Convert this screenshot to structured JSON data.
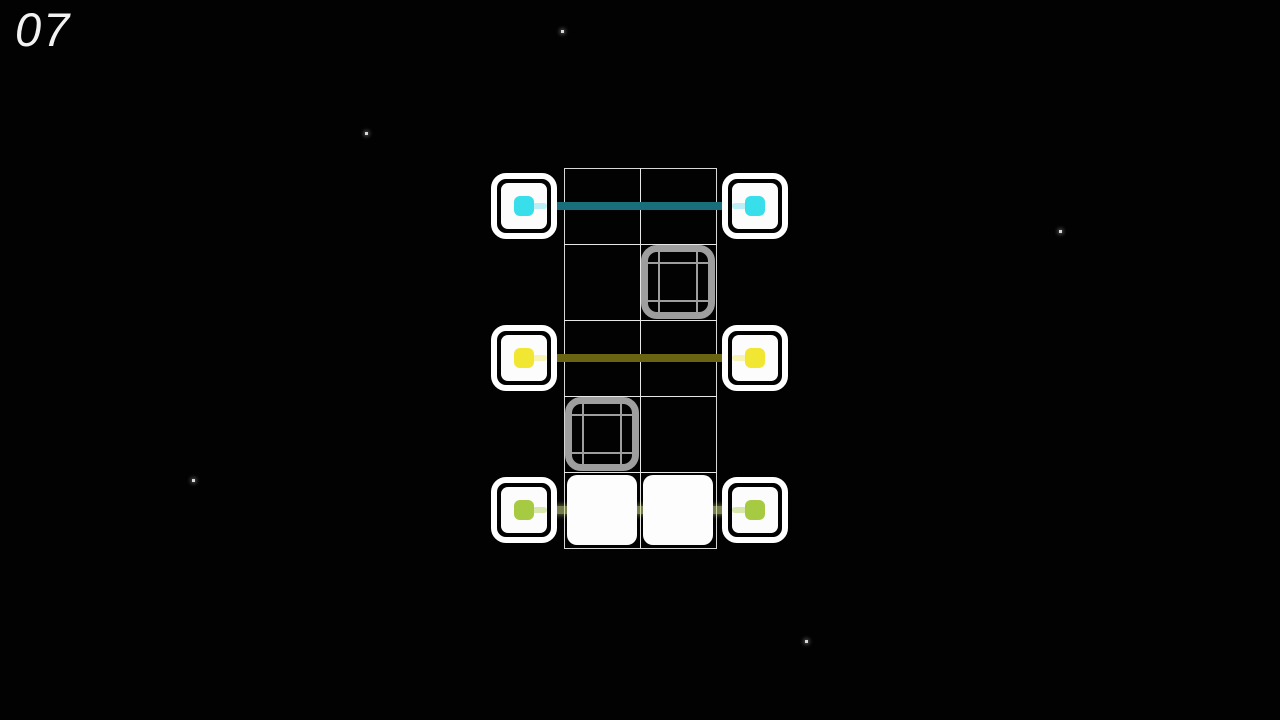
{
  "level": {
    "number": "07"
  },
  "colors": {
    "background": "#020202",
    "grid_line": "#e8e8e8",
    "endpoint_ring": "#ffffff",
    "endpoint_inner": "#fcfcfc",
    "filled_cell": "#fdfdfd",
    "obstacle_gray": "#9e9e9e",
    "star": "#d8d8d8"
  },
  "board": {
    "grid": {
      "rows": 5,
      "cols": 2
    },
    "pairs": [
      {
        "name": "cyan",
        "row": 0,
        "square_color": "#38dfea",
        "line_color": "#186e7a",
        "glow_color": "rgba(110,225,238,0.45)",
        "line_style": "solid",
        "state": "connected"
      },
      {
        "name": "yellow",
        "row": 2,
        "square_color": "#f1e733",
        "line_color": "#696412",
        "glow_color": "rgba(240,232,70,0.40)",
        "line_style": "solid",
        "state": "connected"
      },
      {
        "name": "green",
        "row": 4,
        "square_color": "#a6ca41",
        "line_color": "rgba(214,228,140,0.55)",
        "glow_color": "rgba(180,210,90,0.50)",
        "line_style": "glow",
        "state": "connected-filled"
      }
    ],
    "obstacles": [
      {
        "row": 1,
        "col": 1
      },
      {
        "row": 3,
        "col": 0
      }
    ],
    "filled_cells": [
      {
        "row": 4,
        "col": 0
      },
      {
        "row": 4,
        "col": 1
      }
    ]
  },
  "stars": [
    {
      "x": 562,
      "y": 31
    },
    {
      "x": 366,
      "y": 133
    },
    {
      "x": 1060,
      "y": 231
    },
    {
      "x": 193,
      "y": 480
    },
    {
      "x": 806,
      "y": 641
    }
  ]
}
